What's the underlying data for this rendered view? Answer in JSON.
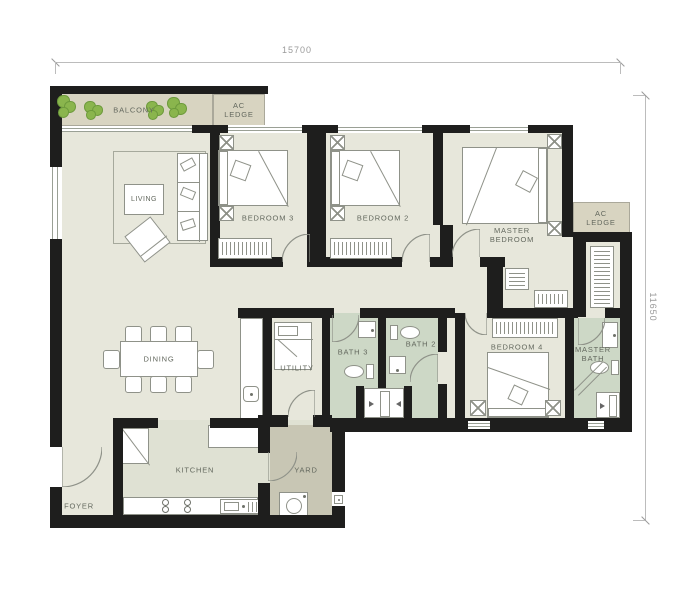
{
  "dimensions": {
    "width_label": "15700",
    "height_label": "11650"
  },
  "rooms": {
    "balcony": "BALCONY",
    "ac_ledge_top": "AC\nLEDGE",
    "living": "LIVING",
    "bedroom3": "BEDROOM 3",
    "bedroom2": "BEDROOM 2",
    "master_bedroom": "MASTER\nBEDROOM",
    "ac_ledge_right": "AC\nLEDGE",
    "dining": "DINING",
    "utility": "UTILITY",
    "bath3": "BATH 3",
    "bath2": "BATH 2",
    "bedroom4": "BEDROOM 4",
    "master_bath": "MASTER\nBATH",
    "kitchen": "KITCHEN",
    "yard": "YARD",
    "foyer": "FOYER"
  },
  "colors": {
    "wall": "#1e1e1d",
    "floor_main": "#e7e7db",
    "floor_kitchen": "#dfe1d3",
    "floor_bath": "#cdd8c6",
    "floor_balcony": "#d8d4c1",
    "floor_yard": "#c8c6b4",
    "furniture_line": "#8f9289",
    "label_text": "#63685e",
    "dimension_text": "#9a9a9a",
    "plant_green": "#8ab54d"
  }
}
